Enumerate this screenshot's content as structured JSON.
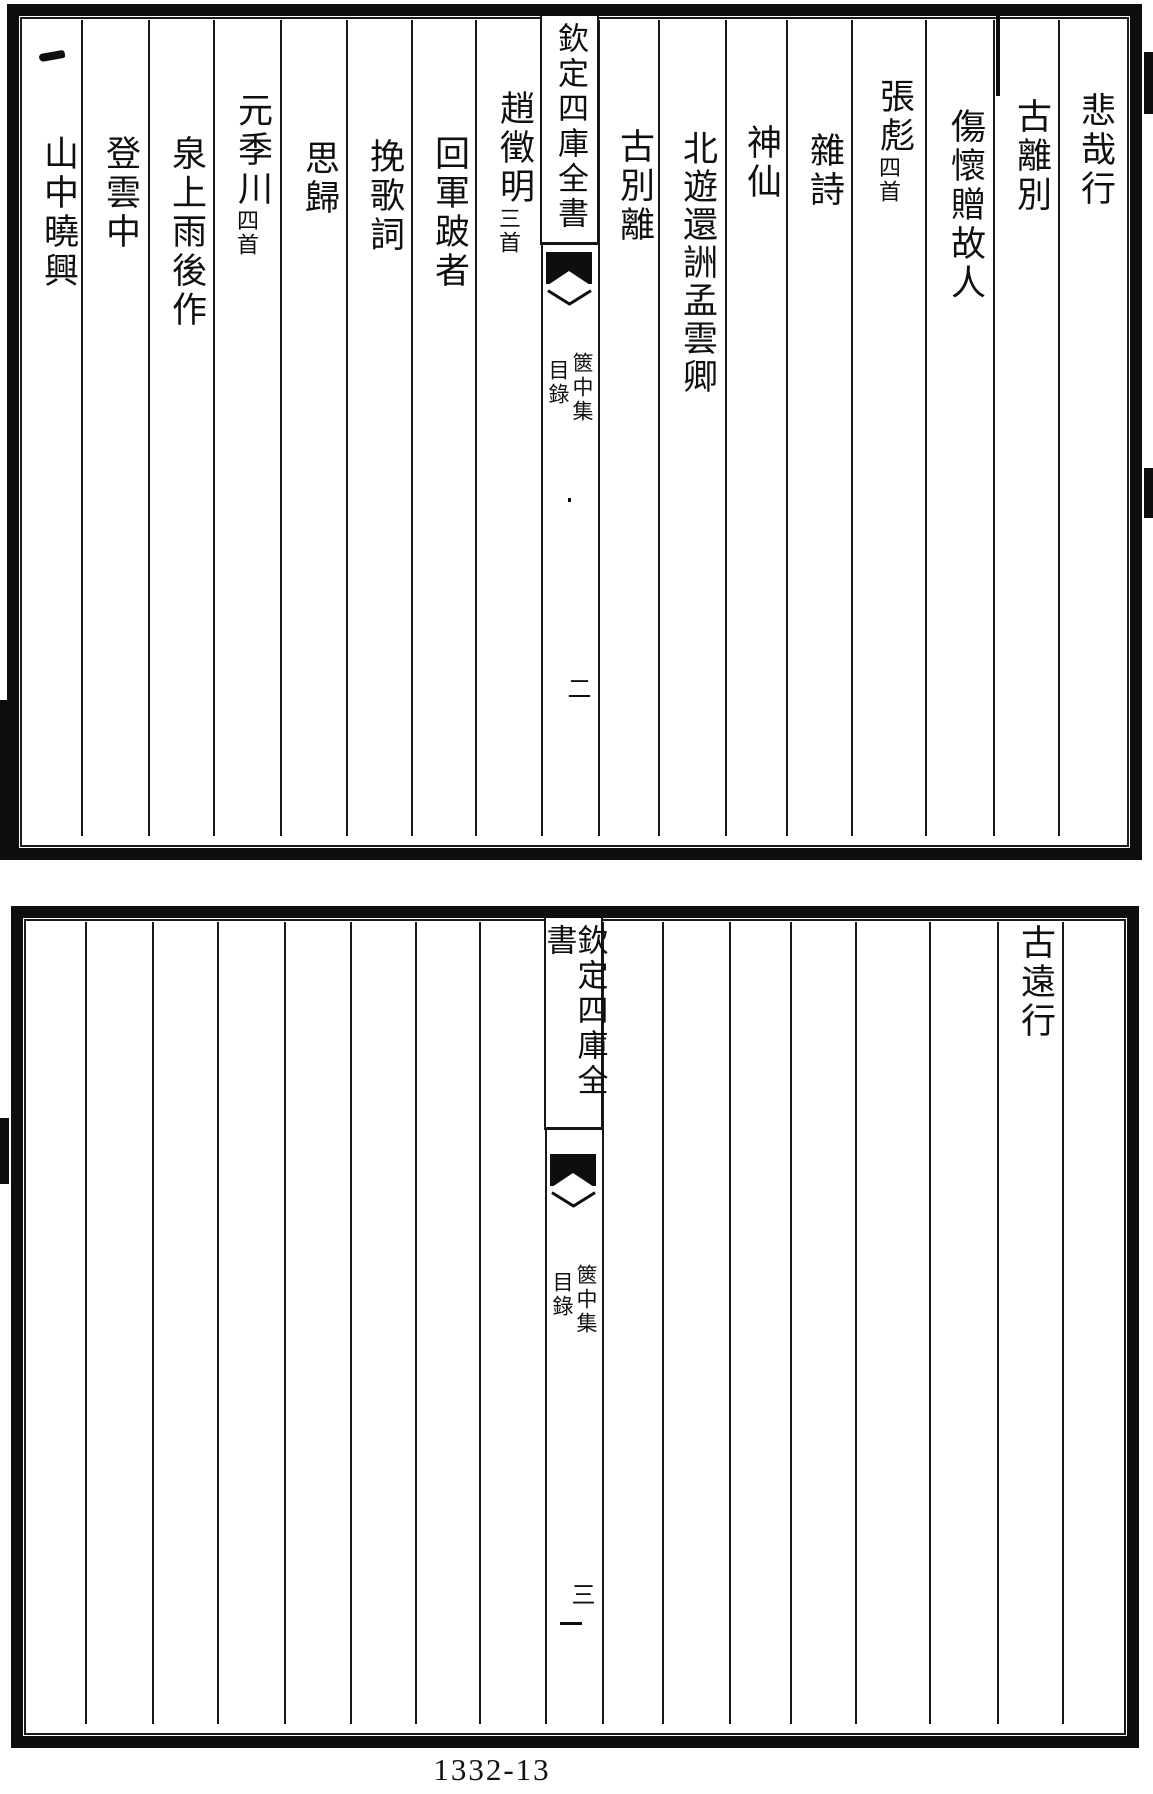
{
  "colors": {
    "ink": "#101010",
    "paper": "#ffffff"
  },
  "footer": {
    "page_label": "1332-13"
  },
  "top_page": {
    "banner": "欽定四庫全書",
    "book_title": "篋中集",
    "section_title": "目錄",
    "folio_number": "二",
    "entries": [
      {
        "title": "悲哉行",
        "note": ""
      },
      {
        "title": "古離別",
        "note": ""
      },
      {
        "title": "傷懷贈故人",
        "note": ""
      },
      {
        "title": "張彪",
        "note": "四首"
      },
      {
        "title": "雜詩",
        "note": ""
      },
      {
        "title": "神仙",
        "note": ""
      },
      {
        "title": "北遊還詶孟雲卿",
        "note": ""
      },
      {
        "title": "古別離",
        "note": ""
      },
      {
        "title": "趙徵明",
        "note": "三首"
      },
      {
        "title": "回軍跛者",
        "note": ""
      },
      {
        "title": "挽歌詞",
        "note": ""
      },
      {
        "title": "思歸",
        "note": ""
      },
      {
        "title": "元季川",
        "note": "四首"
      },
      {
        "title": "泉上雨後作",
        "note": ""
      },
      {
        "title": "登雲中",
        "note": ""
      },
      {
        "title": "山中曉興",
        "note": "",
        "prefix_mark": "一"
      }
    ]
  },
  "bottom_page": {
    "banner": "欽定四庫全書",
    "book_title": "篋中集",
    "section_title": "目錄",
    "folio_number": "三",
    "entries": [
      {
        "title": "古遠行",
        "note": ""
      }
    ]
  }
}
